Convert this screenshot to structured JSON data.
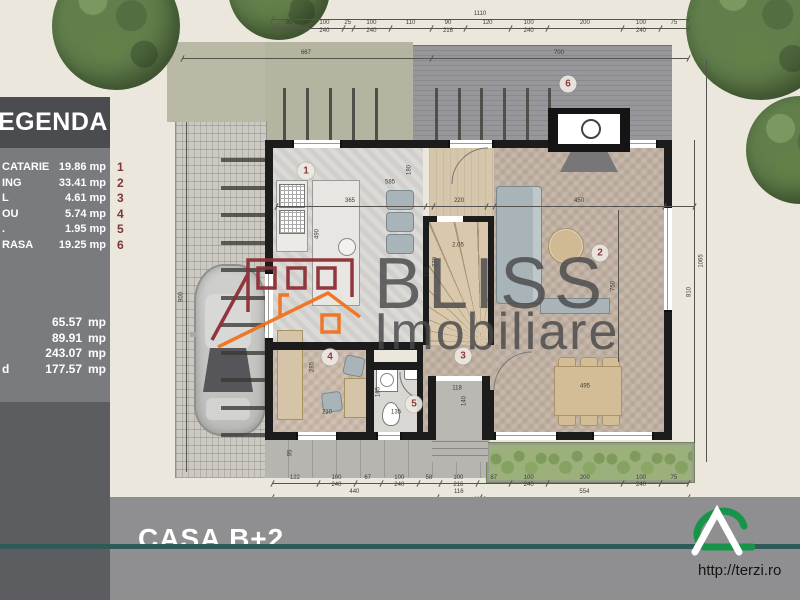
{
  "legend": {
    "title": "EGENDA",
    "items": [
      {
        "num": "1",
        "label": "CATARIE",
        "value": "19.86 mp"
      },
      {
        "num": "2",
        "label": "ING",
        "value": "33.41 mp"
      },
      {
        "num": "3",
        "label": "L",
        "value": "4.61 mp"
      },
      {
        "num": "4",
        "label": "OU",
        "value": "5.74 mp"
      },
      {
        "num": "5",
        "label": ".",
        "value": "1.95 mp"
      },
      {
        "num": "6",
        "label": "RASA",
        "value": "19.25 mp"
      }
    ],
    "totals": [
      {
        "label": "",
        "value": "65.57",
        "unit": "mp"
      },
      {
        "label": "",
        "value": "89.91",
        "unit": "mp"
      },
      {
        "label": "",
        "value": "243.07",
        "unit": "mp"
      },
      {
        "label": "d",
        "value": "177.57",
        "unit": "mp"
      }
    ]
  },
  "watermark": {
    "brand": "BLISS",
    "brand2": "Imobiliare"
  },
  "footer": {
    "project": "CASA B+2",
    "url": "http://terzi.ro"
  },
  "colors": {
    "accent_teal": "#2e5b58",
    "brand_maroon": "#8d2e36",
    "brand_orange": "#ee7320",
    "legend_number": "#7e353c",
    "logo_green": "#18944a"
  },
  "plan": {
    "badges": [
      {
        "n": "1",
        "x": 306,
        "y": 171
      },
      {
        "n": "2",
        "x": 600,
        "y": 253
      },
      {
        "n": "3",
        "x": 463,
        "y": 356
      },
      {
        "n": "4",
        "x": 330,
        "y": 357
      },
      {
        "n": "5",
        "x": 414,
        "y": 404
      },
      {
        "n": "6",
        "x": 568,
        "y": 84
      }
    ],
    "chains": [
      {
        "x": 272,
        "y": 12,
        "w": 416,
        "line": true,
        "ticks": [
          0,
          1
        ],
        "labels": [
          {
            "v": "1110",
            "f": 0.5
          }
        ]
      },
      {
        "x": 272,
        "y": 21,
        "w": 416,
        "line": true,
        "ticks": [
          0,
          0.081,
          0.171,
          0.194,
          0.284,
          0.383,
          0.464,
          0.572,
          0.662,
          0.842,
          0.932,
          1
        ],
        "labels": [
          {
            "v": "90",
            "f": 0.041
          },
          {
            "v": "100",
            "f": 0.126
          },
          {
            "v": "25",
            "f": 0.182
          },
          {
            "v": "100",
            "f": 0.239
          },
          {
            "v": "110",
            "f": 0.333
          },
          {
            "v": "90",
            "f": 0.423
          },
          {
            "v": "120",
            "f": 0.518
          },
          {
            "v": "100",
            "f": 0.617
          },
          {
            "v": "200",
            "f": 0.752
          },
          {
            "v": "100",
            "f": 0.887
          },
          {
            "v": "75",
            "f": 0.966
          }
        ]
      },
      {
        "x": 272,
        "y": 29,
        "w": 416,
        "line": false,
        "labels": [
          {
            "v": "240",
            "f": 0.126
          },
          {
            "v": "240",
            "f": 0.239
          },
          {
            "v": "216",
            "f": 0.423
          },
          {
            "v": "240",
            "f": 0.617
          },
          {
            "v": "240",
            "f": 0.887
          }
        ]
      },
      {
        "x": 182,
        "y": 51,
        "w": 506,
        "line": true,
        "ticks": [
          0,
          0.492,
          1
        ],
        "labels": [
          {
            "v": "667",
            "f": 0.245
          },
          {
            "v": "700",
            "f": 0.745
          }
        ]
      },
      {
        "x": 276,
        "y": 199,
        "w": 418,
        "line": true,
        "ticks": [
          0,
          0.356,
          0.376,
          0.502,
          0.521,
          0.928,
          1
        ],
        "labels": [
          {
            "v": "365",
            "f": 0.177
          },
          {
            "v": "220",
            "f": 0.438
          },
          {
            "v": "450",
            "f": 0.725
          }
        ]
      },
      {
        "x": 272,
        "y": 476,
        "w": 416,
        "line": true,
        "ticks": [
          0,
          0.11,
          0.2,
          0.261,
          0.351,
          0.403,
          0.493,
          0.572,
          0.662,
          0.842,
          0.932,
          1
        ],
        "labels": [
          {
            "v": "122",
            "f": 0.055
          },
          {
            "v": "100",
            "f": 0.155
          },
          {
            "v": "67",
            "f": 0.23
          },
          {
            "v": "100",
            "f": 0.306
          },
          {
            "v": "58",
            "f": 0.377
          },
          {
            "v": "100",
            "f": 0.448
          },
          {
            "v": "87",
            "f": 0.533
          },
          {
            "v": "100",
            "f": 0.617
          },
          {
            "v": "200",
            "f": 0.752
          },
          {
            "v": "100",
            "f": 0.887
          },
          {
            "v": "75",
            "f": 0.966
          }
        ]
      },
      {
        "x": 272,
        "y": 483,
        "w": 416,
        "line": false,
        "labels": [
          {
            "v": "240",
            "f": 0.155
          },
          {
            "v": "240",
            "f": 0.306
          },
          {
            "v": "216",
            "f": 0.448
          },
          {
            "v": "240",
            "f": 0.617
          },
          {
            "v": "240",
            "f": 0.887
          }
        ]
      },
      {
        "x": 272,
        "y": 490,
        "w": 416,
        "line": true,
        "ticks": [
          0,
          0.396,
          0.501,
          1
        ],
        "labels": [
          {
            "v": "440",
            "f": 0.198
          },
          {
            "v": "116",
            "f": 0.449
          },
          {
            "v": "554",
            "f": 0.751
          }
        ]
      },
      {
        "x": 272,
        "y": 498,
        "w": 416,
        "line": true,
        "ticks": [
          0,
          1
        ],
        "labels": [
          {
            "v": "1110",
            "f": 0.5
          }
        ]
      }
    ],
    "vdims": [
      {
        "v": "900",
        "x": 186,
        "y1": 122,
        "y2": 472
      },
      {
        "v": "810",
        "x": 694,
        "y1": 140,
        "y2": 443
      },
      {
        "v": "1065",
        "x": 706,
        "y1": 60,
        "y2": 462
      },
      {
        "v": "750",
        "x": 618,
        "y1": 210,
        "y2": 362
      }
    ],
    "labels": [
      {
        "v": "585",
        "x": 390,
        "y": 183
      },
      {
        "v": "180",
        "x": 410,
        "y": 170,
        "rot": 1
      },
      {
        "v": "490",
        "x": 318,
        "y": 234,
        "rot": 1
      },
      {
        "v": "270",
        "x": 436,
        "y": 262,
        "rot": 1
      },
      {
        "v": "2.05",
        "x": 458,
        "y": 246
      },
      {
        "v": "210",
        "x": 428,
        "y": 272,
        "rot": 1
      },
      {
        "v": "285",
        "x": 313,
        "y": 367,
        "rot": 1
      },
      {
        "v": "210",
        "x": 327,
        "y": 413
      },
      {
        "v": "110",
        "x": 383,
        "y": 346,
        "rot": 1
      },
      {
        "v": "165",
        "x": 379,
        "y": 392,
        "rot": 1
      },
      {
        "v": "135",
        "x": 396,
        "y": 413
      },
      {
        "v": "118",
        "x": 457,
        "y": 389
      },
      {
        "v": "140",
        "x": 465,
        "y": 401,
        "rot": 1
      },
      {
        "v": "95",
        "x": 291,
        "y": 453,
        "rot": 1
      },
      {
        "v": "495",
        "x": 585,
        "y": 387
      }
    ]
  }
}
